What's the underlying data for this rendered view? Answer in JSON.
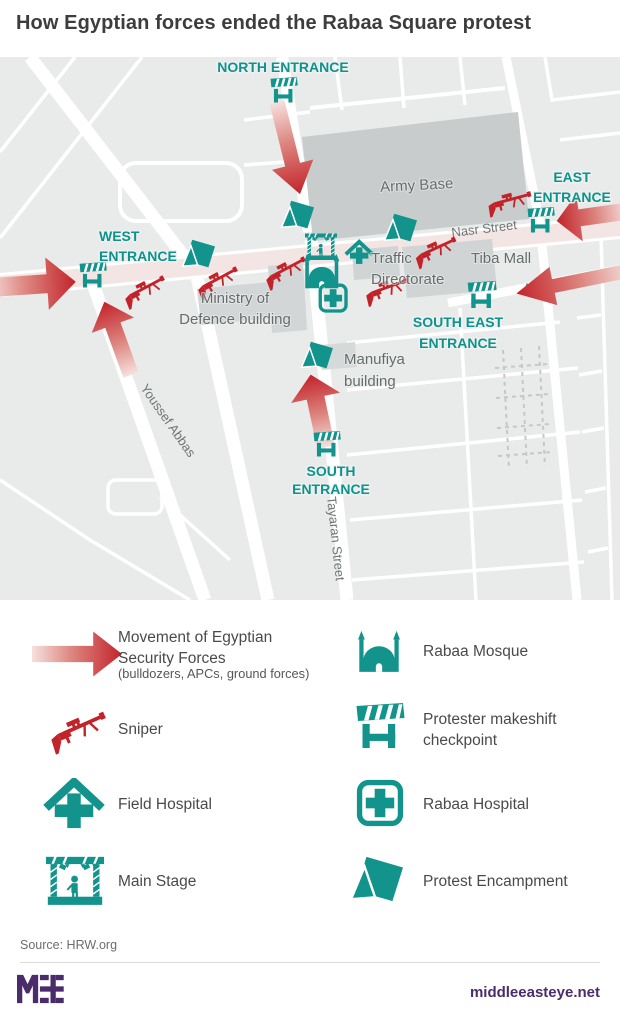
{
  "title": "How Egyptian forces ended the Rabaa Square protest",
  "map": {
    "entrances": {
      "north": {
        "line1": "NORTH ENTRANCE"
      },
      "west": {
        "line1": "WEST",
        "line2": "ENTRANCE"
      },
      "east": {
        "line1": "EAST",
        "line2": "ENTRANCE"
      },
      "south_east": {
        "line1": "SOUTH EAST",
        "line2": "ENTRANCE"
      },
      "south": {
        "line1": "SOUTH",
        "line2": "ENTRANCE"
      }
    },
    "places": {
      "army_base": "Army Base",
      "tiba_mall": "Tiba Mall",
      "traffic_line1": "Traffic",
      "traffic_line2": "Directorate",
      "ministry_line1": "Ministry of",
      "ministry_line2": "Defence building",
      "manufiya_line1": "Manufiya",
      "manufiya_line2": "building"
    },
    "streets": {
      "nasr": "Nasr Street",
      "anwar": "Anwar Al-Mufti",
      "youssef": "Youssef Abbas",
      "tayaran": "Tayaran Street"
    }
  },
  "legend": {
    "items": [
      {
        "icon": "movement-arrow-icon",
        "label": "Movement of Egyptian Security Forces",
        "sublabel": "(bulldozers, APCs, ground forces)"
      },
      {
        "icon": "sniper-icon",
        "label": "Sniper"
      },
      {
        "icon": "field-hospital-icon",
        "label": "Field Hospital"
      },
      {
        "icon": "main-stage-icon",
        "label": "Main Stage"
      },
      {
        "icon": "mosque-icon",
        "label": "Rabaa Mosque"
      },
      {
        "icon": "checkpoint-icon",
        "label": "Protester makeshift checkpoint"
      },
      {
        "icon": "rabaa-hospital-icon",
        "label": "Rabaa Hospital"
      },
      {
        "icon": "tent-icon",
        "label": "Protest Encampment"
      }
    ]
  },
  "footer": {
    "source": "Source: HRW.org",
    "site": "middleeasteye.net",
    "logo": "MEE"
  },
  "colors": {
    "teal": "#12948c",
    "red": "#c2232a",
    "purple": "#4b2c6b",
    "map_bg": "#e9eaea",
    "building": "#c8cccc",
    "road_highlight": "#f3e5e3"
  }
}
